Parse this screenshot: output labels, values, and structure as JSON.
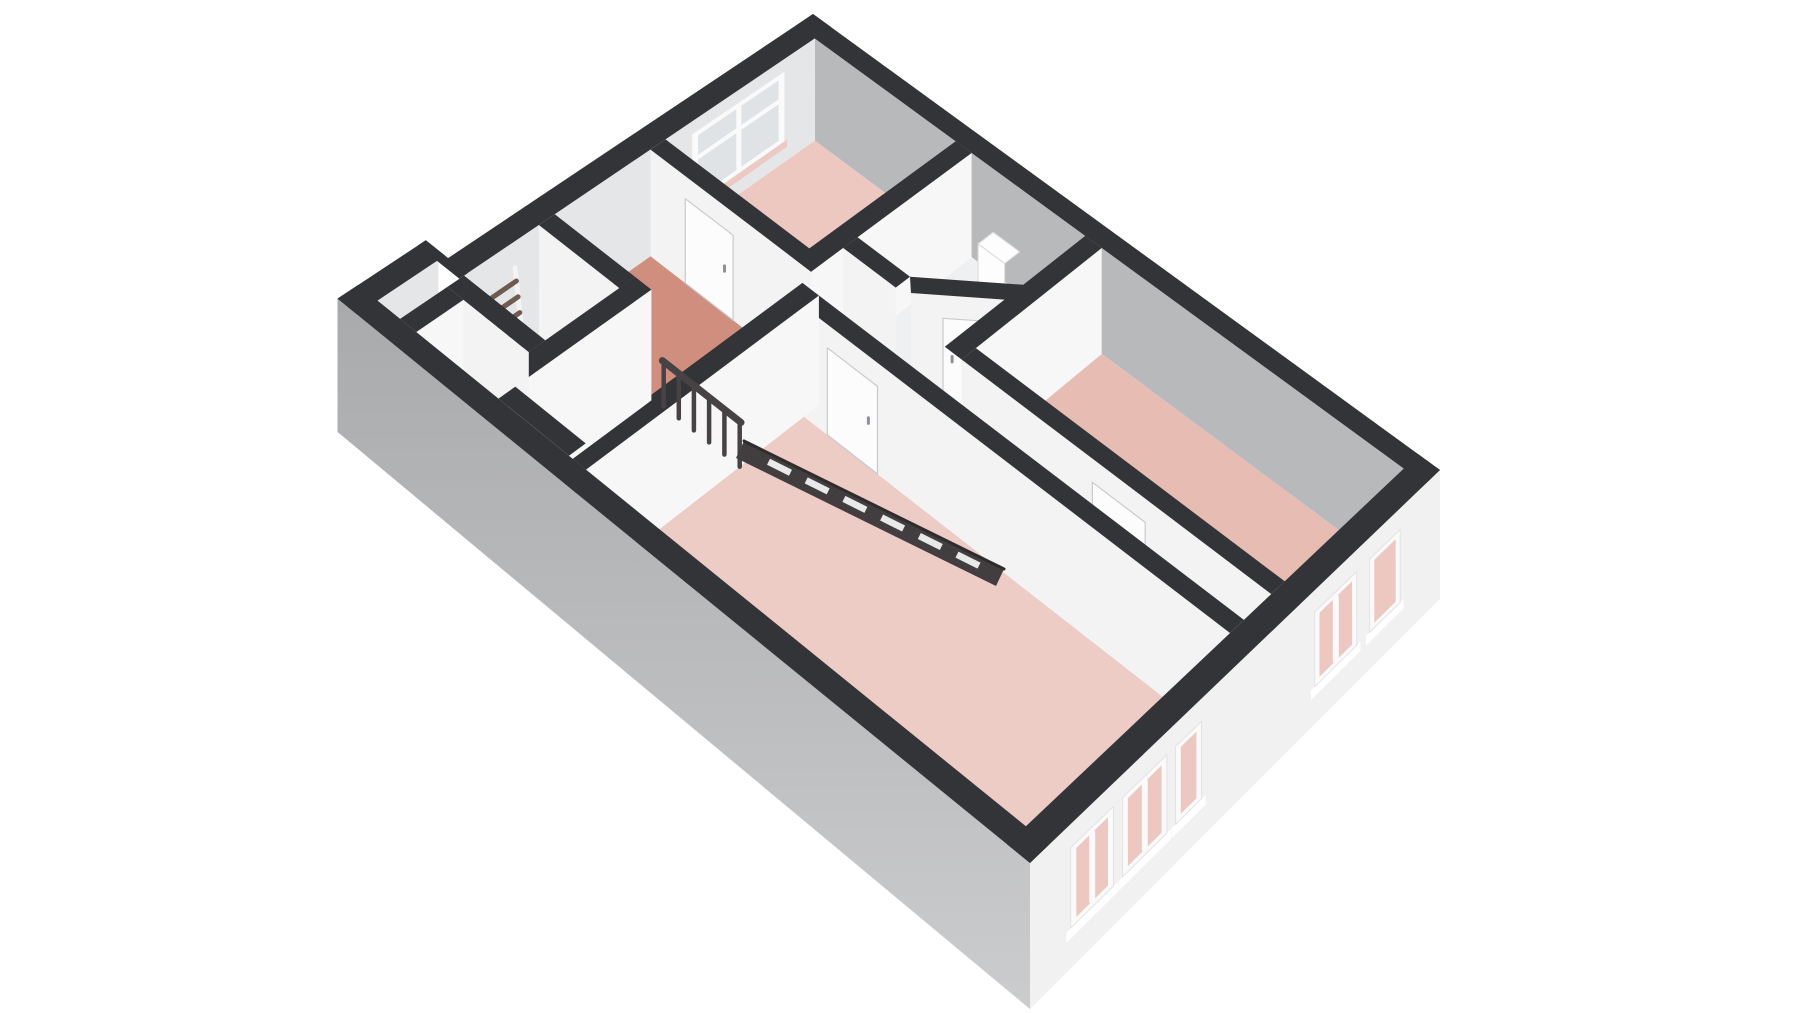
{
  "page": {
    "kind": "3d-floorplan-render",
    "background": "#ffffff",
    "view": "isometric-perspective-from-south-east"
  },
  "palette": {
    "wall_cap": "#333437",
    "ne_facade_interior": "#b7b9bb",
    "nw_facade_interior": "#e5e6e8",
    "wall_face_south": "#f3f3f4",
    "wall_face_east": "#f7f7f8",
    "exterior_sw_top": "#a9aaac",
    "exterior_sw_bottom": "#cbccce",
    "exterior_se": "#f1f1f2",
    "stair_base": "#9b9c9f",
    "stair_tread": "#f3f3f4",
    "stair_riser": "#dddde0",
    "stair_stringer": "#ececee",
    "railing": "#474344",
    "balustrade_band": "#423e40",
    "door_leaf": "#fcfcfd",
    "door_edge": "#c9cacd",
    "tan_door_leaf": "#b7ae9b",
    "ladder_rail": "#f4f4f5",
    "ladder_rung": "#6f5b51",
    "window_frame": "#fafafa",
    "window_glass": "#dfe3e6",
    "window_glass_room": "#ecc8c1",
    "window_sill_pink": "#eccac3",
    "handle": "#8f9094",
    "toilet_white": "#fdfdfe",
    "toilet_edge": "#d9dadc",
    "sink_white": "#f7f8f9",
    "gap_floor": "#dcdddf"
  },
  "rooms": [
    {
      "id": "bedroom-top",
      "floor_color": "#ecc8c1"
    },
    {
      "id": "bedroom-right",
      "floor_color": "#e6bcb3"
    },
    {
      "id": "bedroom-front",
      "floor_color": "#edccc6"
    },
    {
      "id": "bedroom-left",
      "floor_color": "#e7c0b8"
    },
    {
      "id": "landing",
      "floor_color": "#d08e7e"
    },
    {
      "id": "corridor",
      "floor_color": "#e9c3bb"
    },
    {
      "id": "bathroom",
      "floor_color": "#eef0f1"
    },
    {
      "id": "closet",
      "floor_color": "#e3e4e6"
    }
  ],
  "features": {
    "stairs": {
      "type": "winder",
      "treads": 8,
      "railing_balusters": 6
    },
    "windows": [
      {
        "id": "window-nw-top-bedroom",
        "sashes": 2,
        "panes": 4
      },
      {
        "id": "window-se-right-narrow",
        "sashes": 1
      },
      {
        "id": "window-se-right-wide",
        "sashes": 2
      },
      {
        "id": "window-se-front-narrow",
        "sashes": 1
      },
      {
        "id": "window-se-front-wide-1",
        "sashes": 2
      },
      {
        "id": "window-se-front-wide-2",
        "sashes": 2
      }
    ],
    "doors": [
      {
        "id": "door-top-bedroom",
        "state": "closed"
      },
      {
        "id": "door-bathroom",
        "state": "closed",
        "wall": "angled"
      },
      {
        "id": "door-right-bedroom",
        "state": "closed"
      },
      {
        "id": "door-front-bedroom",
        "state": "closed"
      },
      {
        "id": "door-left-bedroom",
        "state": "open",
        "leaf_color_key": "tan_door_leaf"
      }
    ],
    "fixtures": [
      {
        "id": "toilet"
      },
      {
        "id": "sink"
      },
      {
        "id": "ladder"
      }
    ]
  }
}
